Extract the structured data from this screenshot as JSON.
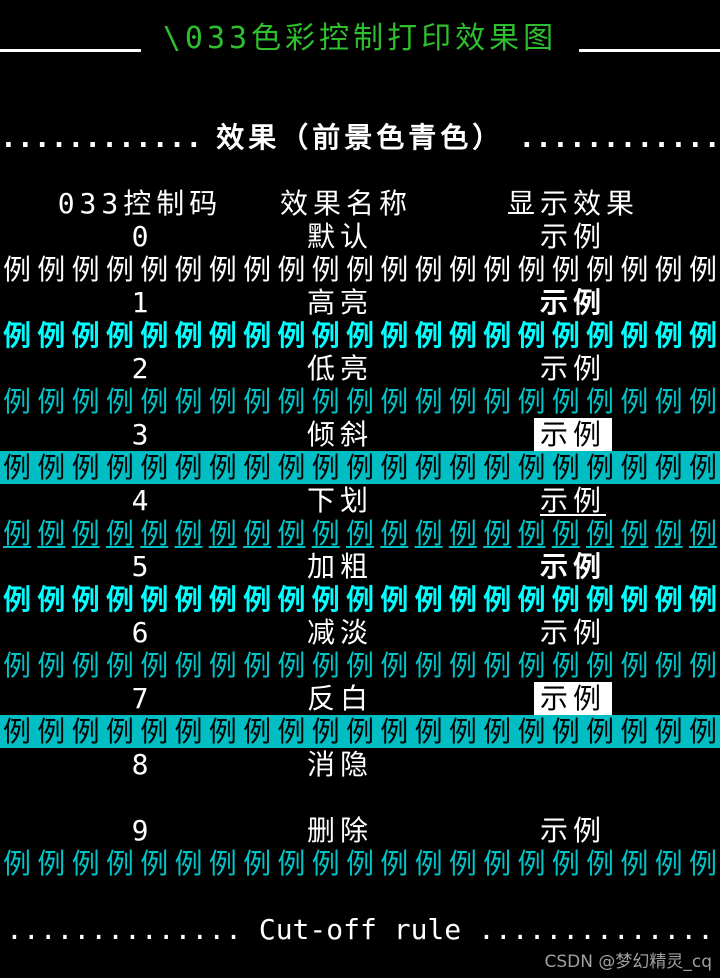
{
  "terminal": {
    "title": {
      "text": "\\033色彩控制打印效果图"
    },
    "section_header": {
      "left_dots": "............",
      "label": "效果（前景色青色）",
      "right_dots": "............"
    },
    "columns": {
      "code": "033控制码",
      "name": "效果名称",
      "effect": "显示效果"
    },
    "sample_text": "示例",
    "demo": {
      "char": "例",
      "count": 21
    },
    "rows": [
      {
        "code": "0",
        "name": "默认",
        "sample_style": "plain",
        "demo_style": "white"
      },
      {
        "code": "1",
        "name": "高亮",
        "sample_style": "bold",
        "demo_style": "bright"
      },
      {
        "code": "2",
        "name": "低亮",
        "sample_style": "plain",
        "demo_style": "cyan"
      },
      {
        "code": "3",
        "name": "倾斜",
        "sample_style": "inverse",
        "demo_style": "band"
      },
      {
        "code": "4",
        "name": "下划",
        "sample_style": "underline",
        "demo_style": "cyan-underline"
      },
      {
        "code": "5",
        "name": "加粗",
        "sample_style": "bold",
        "demo_style": "bright"
      },
      {
        "code": "6",
        "name": "减淡",
        "sample_style": "plain",
        "demo_style": "cyan"
      },
      {
        "code": "7",
        "name": "反白",
        "sample_style": "inverse",
        "demo_style": "band"
      },
      {
        "code": "8",
        "name": "消隐",
        "sample_style": "hidden",
        "demo_style": "hidden"
      },
      {
        "code": "9",
        "name": "删除",
        "sample_style": "plain",
        "demo_style": "cyan"
      }
    ],
    "cutoff_rule": {
      "text": ".............. Cut-off rule .............."
    },
    "watermark": "CSDN @梦幻精灵_cq",
    "colors": {
      "background": "#000000",
      "title_green": "#2EBE2E",
      "white": "#FFFFFF",
      "cyan_bright": "#00FFFF",
      "cyan": "#00C5C8",
      "cyan_band": "#00BEC4",
      "watermark_gray": "#A0A0A0"
    }
  }
}
